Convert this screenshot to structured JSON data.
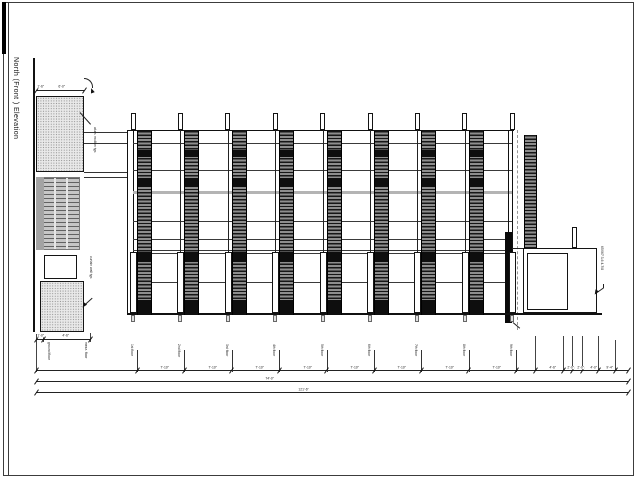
{
  "title": "North (Front ) Elevation",
  "colors": {
    "line": "#1a1a1a",
    "stripe_dark": "#161616",
    "stripe_light": "#8d8d8d",
    "stipple_fill": "#e9e9e9",
    "louver_gray": "#c6c6c6",
    "slab_gray": "#b4b4b4"
  },
  "notes": {
    "mullion_note": "alum. mullion typ.",
    "curtainwall_note": "curtain wall typ.",
    "right_note": "65X67 3-6 4-7/8"
  },
  "dims": {
    "tower_top": [
      "1'-6\"",
      "6'-0\""
    ],
    "tower_bottom": [
      "1'-0\"",
      "4'-6\""
    ],
    "grid_labels": [
      "ground floor",
      "mezz. floor",
      "1st floor",
      "2nd floor",
      "3rd floor",
      "4th floor",
      "5th floor",
      "6th floor",
      "7th floor",
      "8th floor",
      "9th floor"
    ],
    "span_labels": [
      "7'-10\"",
      "7'-10\"",
      "7'-10\"",
      "7'-10\"",
      "7'-10\"",
      "7'-10\"",
      "7'-10\"",
      "7'-10\""
    ],
    "right_spans": [
      "4'-6\"",
      "2'-0\"",
      "2'-0\"",
      "4'-0\"",
      "9'-4\""
    ],
    "total_1": "74'-0\"",
    "total_2": "121'-6\""
  }
}
